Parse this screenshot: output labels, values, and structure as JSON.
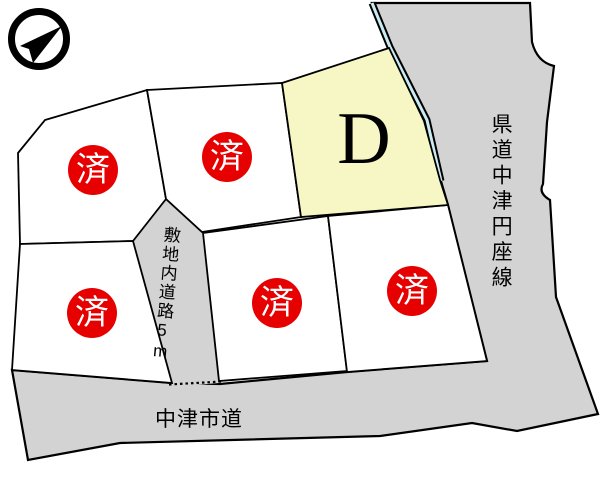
{
  "compass": {
    "icon": "north-arrow"
  },
  "lots": [
    {
      "id": "1",
      "status": "済"
    },
    {
      "id": "2",
      "status": "済"
    },
    {
      "id": "3",
      "status": "済"
    },
    {
      "id": "4",
      "status": "済"
    },
    {
      "id": "5",
      "status": "済"
    },
    {
      "id": "D",
      "label": "D"
    }
  ],
  "roads": {
    "internal_label": "敷地内道路5m",
    "city_label": "中津市道",
    "prefectural_label": "県道中津円座線"
  },
  "colors": {
    "background": "#ffffff",
    "road_fill": "#d3d3d3",
    "lot_fill": "#ffffff",
    "available_lot_fill": "#f7f7c5",
    "sold_badge_fill": "#e60000",
    "sold_badge_text": "#ffffff",
    "waterway": "#c9ecf2",
    "outline": "#000000"
  }
}
